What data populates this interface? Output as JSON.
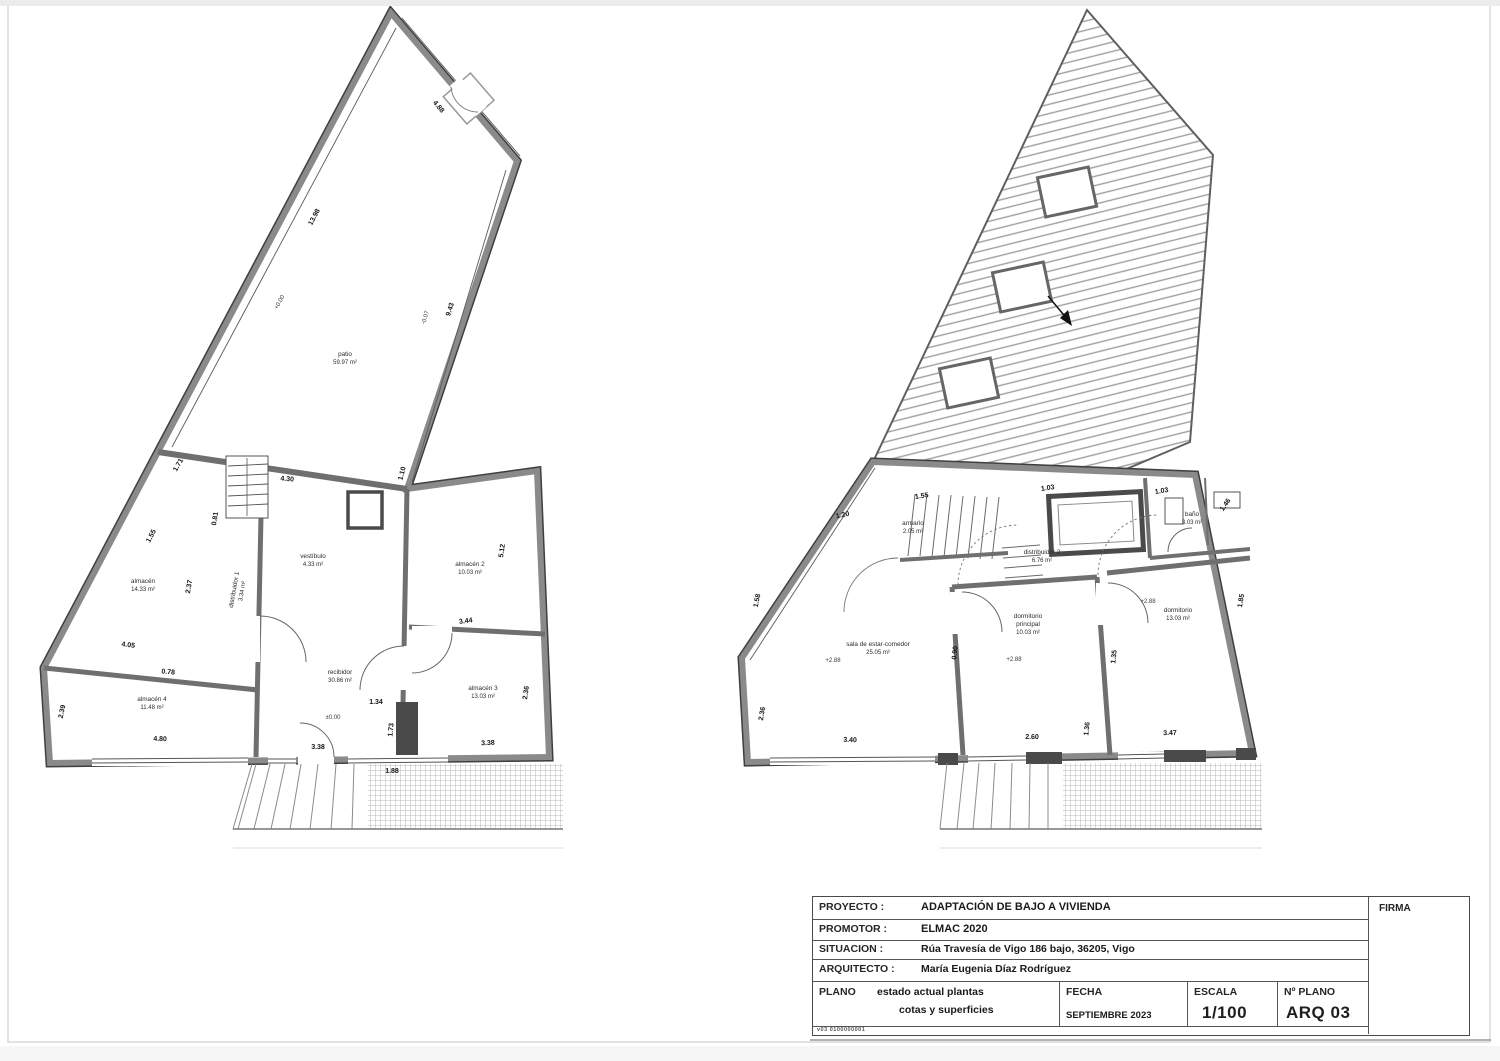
{
  "title_block": {
    "rows": [
      {
        "label": "PROYECTO :",
        "value": "ADAPTACIÓN  DE BAJO A VIVIENDA"
      },
      {
        "label": "PROMOTOR :",
        "value": "ELMAC 2020"
      },
      {
        "label": "SITUACION :",
        "value": "Rúa Travesía de Vigo 186 bajo, 36205, Vigo"
      },
      {
        "label": "ARQUITECTO :",
        "value": "María Eugenia Díaz Rodríguez"
      }
    ],
    "plano_label": "PLANO",
    "plano_line1": "estado actual plantas",
    "plano_line2": "cotas y superficies",
    "fecha_label": "FECHA",
    "fecha_value": "SEPTIEMBRE 2023",
    "escala_label": "ESCALA",
    "escala_value": "1/100",
    "nplano_label": "Nº PLANO",
    "nplano_value": "ARQ 03",
    "firma_label": "FIRMA",
    "ref_code": "v03 0100000001"
  },
  "plans": {
    "left": {
      "rooms": [
        {
          "name": "patio",
          "area": "59.97 m²"
        },
        {
          "name": "almacén",
          "area": "14.33 m²"
        },
        {
          "name": "distribuidor 1",
          "area": "3.34 m²"
        },
        {
          "name": "vestíbulo",
          "area": "4.33 m²"
        },
        {
          "name": "almacén 2",
          "area": "10.03 m²"
        },
        {
          "name": "recibidor",
          "area": "30.86 m²"
        },
        {
          "name": "almacén 3",
          "area": "13.03 m²"
        },
        {
          "name": "almacén 4",
          "area": "11.48 m²"
        }
      ],
      "dims": [
        "4.88",
        "13.98",
        "9.43",
        "1.10",
        "4.30",
        "1.71",
        "1.55",
        "2.37",
        "4.05",
        "0.78",
        "4.80",
        "2.39",
        "3.38",
        "1.34",
        "1.73",
        "3.38",
        "1.88",
        "5.12",
        "3.44",
        "2.36",
        "0.81"
      ],
      "levels": [
        "+0.00",
        "-0.07",
        "±0.00"
      ]
    },
    "right": {
      "rooms": [
        {
          "name": "distribuidor 2",
          "area": "6.76 m²"
        },
        {
          "name": "sala de estar-comedor",
          "area": "25.05 m²"
        },
        {
          "name": "dormitorio",
          "name2": "principal",
          "area": "10.03 m²"
        },
        {
          "name": "dormitorio",
          "area": "13.03 m²"
        },
        {
          "name": "baño",
          "area": "3.03 m²"
        },
        {
          "name": "armario",
          "area": "2.05 m²"
        }
      ],
      "dims": [
        "1.20",
        "1.58",
        "2.36",
        "3.40",
        "2.60",
        "1.36",
        "3.47",
        "1.35",
        "0.90",
        "1.03",
        "1.46",
        "1.03",
        "1.85",
        "1.55"
      ],
      "levels": [
        "+2.88",
        "+2.88",
        "+2.88"
      ]
    }
  }
}
